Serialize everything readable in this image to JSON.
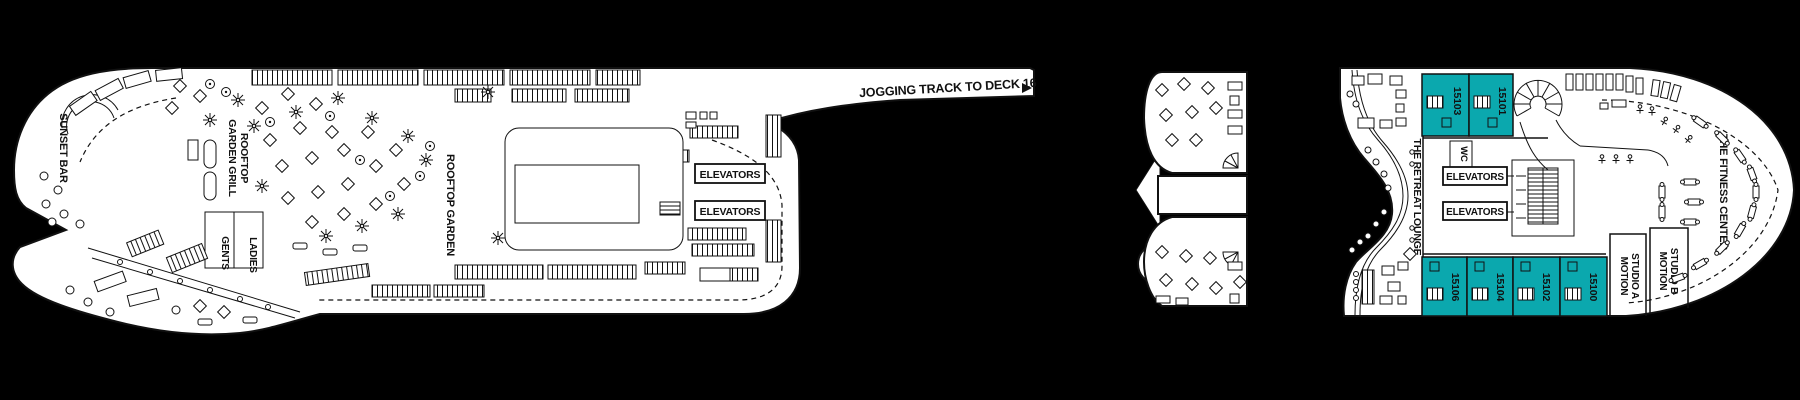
{
  "colors": {
    "background": "#000000",
    "deck": "#ffffff",
    "line": "#111111",
    "cabin_fill": "#0ba8ae"
  },
  "left_section": {
    "sunset_bar": "SUNSET BAR",
    "rooftop_garden_grill": {
      "line1": "ROOFTOP",
      "line2": "GARDEN GRILL"
    },
    "gents": "GENTS",
    "ladies": "LADIES",
    "rooftop_garden": "ROOFTOP GARDEN",
    "elevators_upper": "ELEVATORS",
    "elevators_lower": "ELEVATORS"
  },
  "jogging_track": {
    "label": "JOGGING TRACK TO DECK 16"
  },
  "right_section": {
    "retreat_lounge": "THE RETREAT LOUNGE",
    "wc": "WC",
    "elevators_upper": "ELEVATORS",
    "elevators_lower": "ELEVATORS",
    "motion_studio_a": {
      "line1": "MOTION",
      "line2": "STUDIO A"
    },
    "motion_studio_b": {
      "line1": "MOTION",
      "line2": "STUDIO B"
    },
    "fitness_center": "THE FITNESS CENTER",
    "cabins_top": [
      {
        "number": "15103"
      },
      {
        "number": "15101"
      }
    ],
    "cabins_bottom": [
      {
        "number": "15106"
      },
      {
        "number": "15104"
      },
      {
        "number": "15102"
      },
      {
        "number": "15100"
      }
    ]
  }
}
